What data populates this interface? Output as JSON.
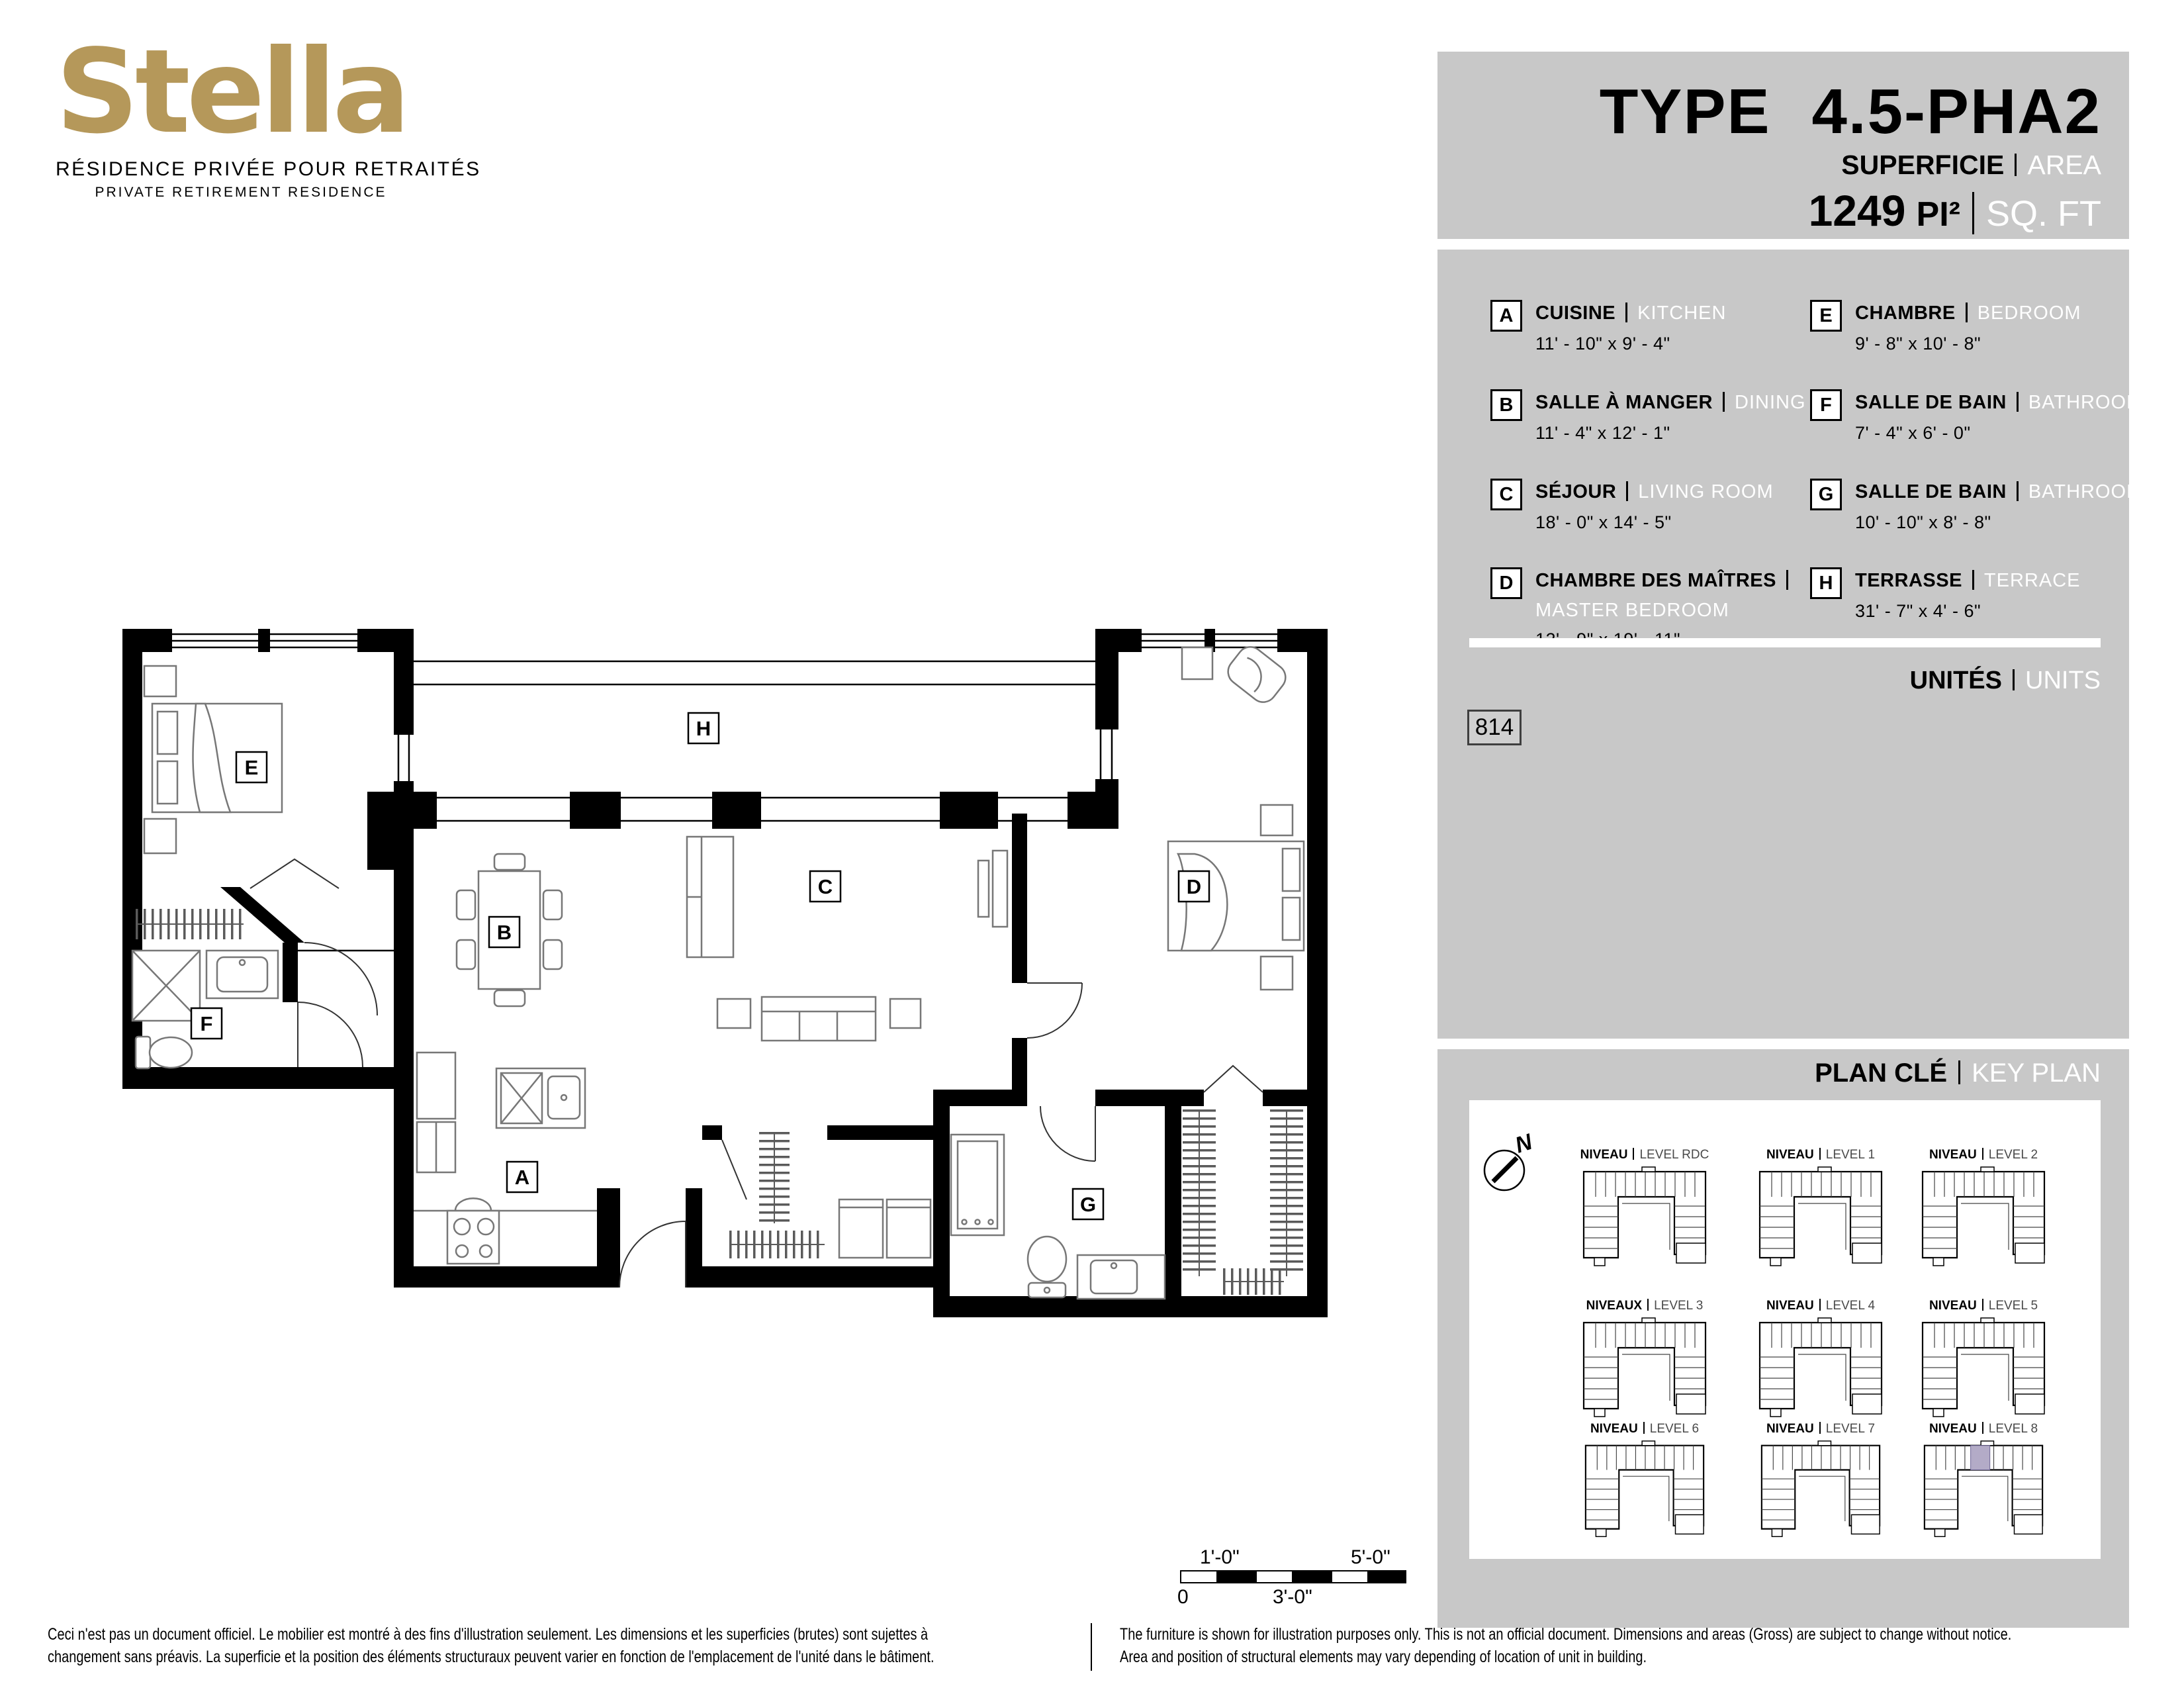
{
  "logo": {
    "name": "Stella",
    "tagline_fr": "RÉSIDENCE PRIVÉE POUR RETRAITÉS",
    "tagline_en": "PRIVATE RETIREMENT RESIDENCE"
  },
  "header": {
    "type_label": "TYPE",
    "type_value": "4.5-PHA2",
    "area_label_fr": "SUPERFICIE",
    "area_label_en": "AREA",
    "area_value": "1249",
    "area_unit_fr": "PI²",
    "area_unit_en": "SQ. FT"
  },
  "legend": {
    "rooms": [
      {
        "letter": "A",
        "name_fr": "CUISINE",
        "name_en": "KITCHEN",
        "dims": "11' - 10\" x 9' - 4\""
      },
      {
        "letter": "B",
        "name_fr": "SALLE À MANGER",
        "name_en": "DINING",
        "dims": "11' - 4\" x 12' - 1\""
      },
      {
        "letter": "C",
        "name_fr": "SÉJOUR",
        "name_en": "LIVING ROOM",
        "dims": "18' - 0\" x 14' - 5\""
      },
      {
        "letter": "D",
        "name_fr": "CHAMBRE DES MAÎTRES",
        "name_en": "MASTER BEDROOM",
        "dims": "12' - 9\" x 19' - 11\""
      },
      {
        "letter": "E",
        "name_fr": "CHAMBRE",
        "name_en": "BEDROOM",
        "dims": "9' - 8\" x 10' - 8\""
      },
      {
        "letter": "F",
        "name_fr": "SALLE DE BAIN",
        "name_en": "BATHROOM",
        "dims": "7' - 4\" x 6' - 0\""
      },
      {
        "letter": "G",
        "name_fr": "SALLE DE BAIN",
        "name_en": "BATHROOM",
        "dims": "10' - 10\" x 8' - 8\""
      },
      {
        "letter": "H",
        "name_fr": "TERRASSE",
        "name_en": "TERRACE",
        "dims": "31' - 7\" x 4' - 6\""
      }
    ],
    "units_label_fr": "UNITÉS",
    "units_label_en": "UNITS",
    "unit_number": "814"
  },
  "keyplan": {
    "title_fr": "PLAN CLÉ",
    "title_en": "KEY PLAN",
    "compass": "N",
    "levels": [
      {
        "niveau": "NIVEAU",
        "level": "LEVEL RDC",
        "highlight": false
      },
      {
        "niveau": "NIVEAU",
        "level": "LEVEL 1",
        "highlight": false
      },
      {
        "niveau": "NIVEAU",
        "level": "LEVEL 2",
        "highlight": false
      },
      {
        "niveau": "NIVEAUX",
        "level": "LEVEL 3",
        "highlight": false
      },
      {
        "niveau": "NIVEAU",
        "level": "LEVEL 4",
        "highlight": false
      },
      {
        "niveau": "NIVEAU",
        "level": "LEVEL 5",
        "highlight": false
      },
      {
        "niveau": "NIVEAU",
        "level": "LEVEL 6",
        "highlight": false
      },
      {
        "niveau": "NIVEAU",
        "level": "LEVEL 7",
        "highlight": false
      },
      {
        "niveau": "NIVEAU",
        "level": "LEVEL 8",
        "highlight": true
      }
    ]
  },
  "scalebar": {
    "top_left": "1'-0\"",
    "top_right": "5'-0\"",
    "bottom_left": "0",
    "bottom_mid": "3'-0\""
  },
  "disclaimer": {
    "fr_line1": "Ceci n'est pas un document officiel.  Le mobilier est montré à des fins d'illustration seulement.  Les dimensions et les superficies (brutes) sont sujettes à",
    "fr_line2": "changement sans préavis. La superficie et la position des éléments structuraux peuvent varier en fonction de l'emplacement de l'unité dans le bâtiment.",
    "en_line1": "The furniture is shown for illustration purposes only.  This is not an official document.  Dimensions and areas (Gross) are subject to change without notice.",
    "en_line2": "Area and position of structural elements may vary depending of location of unit in building."
  },
  "colors": {
    "panel_gray": "#c8c8c8",
    "logo_gold": "#b5985a",
    "keyplan_highlight": "#b3abc7"
  }
}
